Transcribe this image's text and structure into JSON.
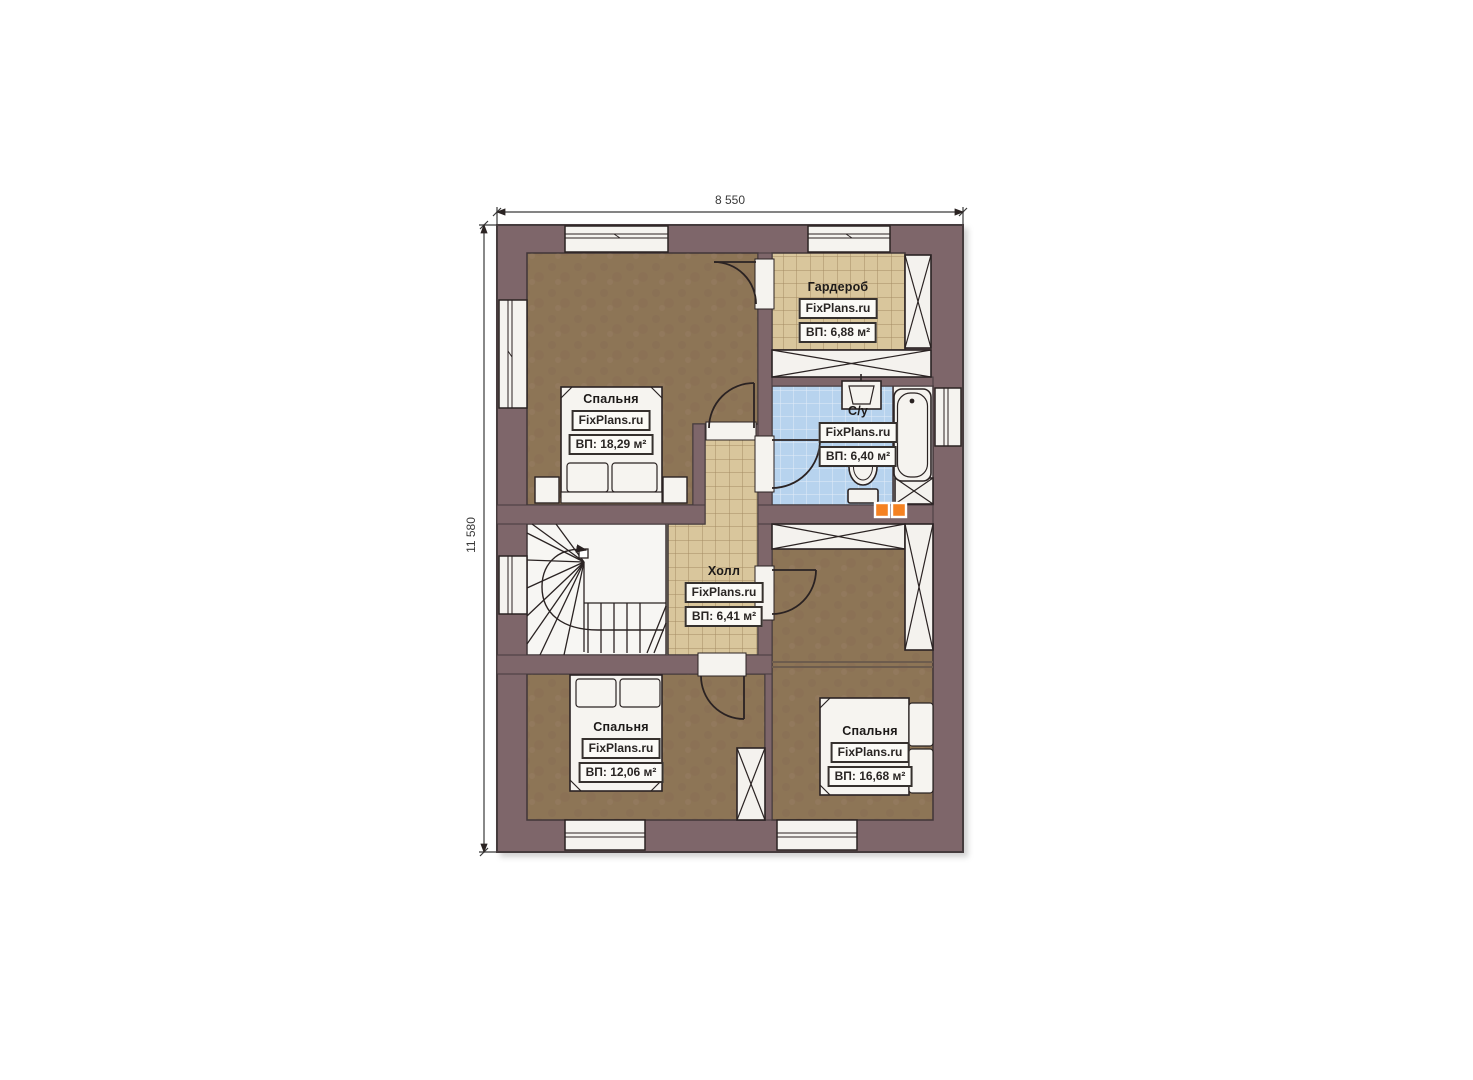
{
  "plan": {
    "dimension_top": "8 550",
    "dimension_left": "11 580",
    "rooms": [
      {
        "name": "Спальня",
        "brand": "FixPlans.ru",
        "area": "ВП: 18,29 м²"
      },
      {
        "name": "Гардероб",
        "brand": "FixPlans.ru",
        "area": "ВП: 6,88 м²"
      },
      {
        "name": "С/у",
        "brand": "FixPlans.ru",
        "area": "ВП: 6,40 м²"
      },
      {
        "name": "Холл",
        "brand": "FixPlans.ru",
        "area": "ВП: 6,41 м²"
      },
      {
        "name": "Спальня",
        "brand": "FixPlans.ru",
        "area": "ВП: 12,06 м²"
      },
      {
        "name": "Спальня",
        "brand": "FixPlans.ru",
        "area": "ВП: 16,68 м²"
      }
    ],
    "colors": {
      "wall": "#7e666b",
      "floor_brown": "#8d7457",
      "tile_tan": "#d9c69c",
      "tile_tan_grid": "#a58c63",
      "tile_blue": "#b7d3ee",
      "tile_blue_grid": "#e3edf8",
      "fixture_white": "#f5f3ef",
      "accent_orange": "#f58220",
      "line_dark": "#2b2423"
    }
  }
}
